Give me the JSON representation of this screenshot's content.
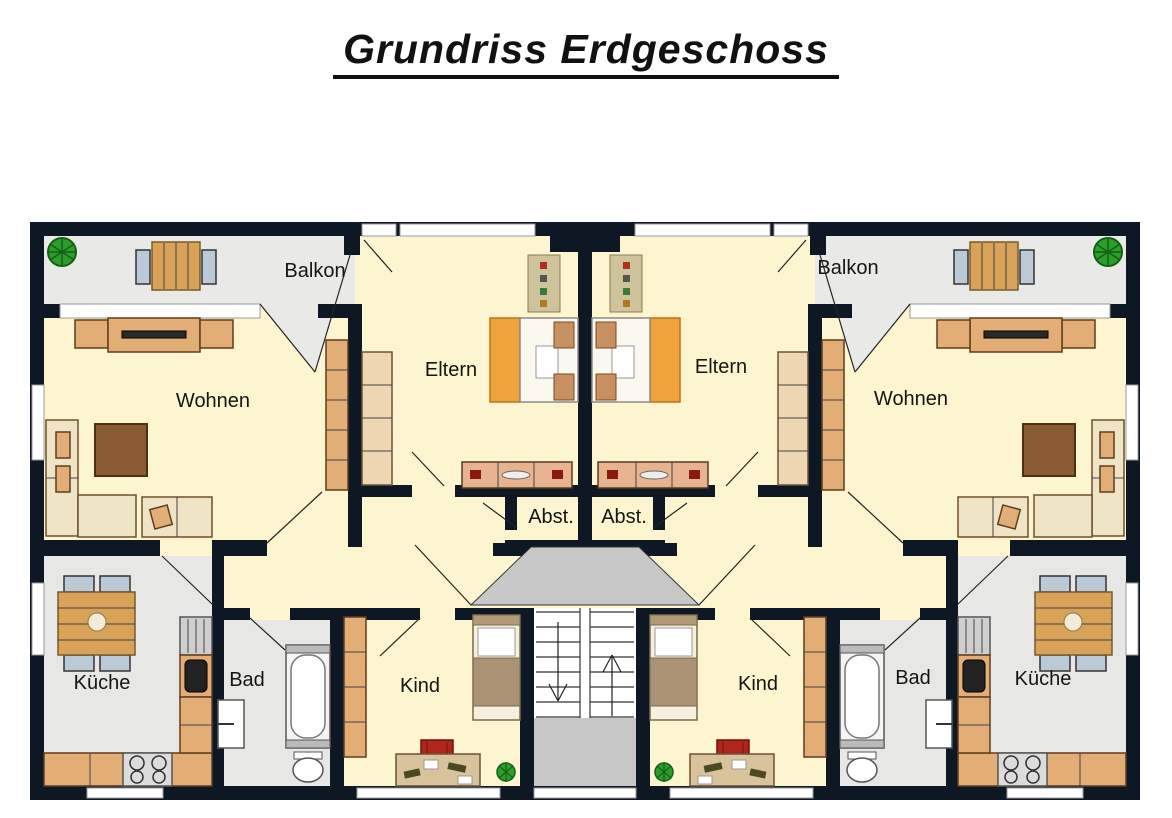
{
  "title": "Grundriss Erdgeschoss",
  "rooms": {
    "balkon": "Balkon",
    "wohnen": "Wohnen",
    "eltern": "Eltern",
    "abst": "Abst.",
    "kueche": "Küche",
    "bad": "Bad",
    "kind": "Kind"
  },
  "stairs": {
    "down_arrow": "down",
    "up_arrow": "up"
  },
  "palette": {
    "wall": "#0e1724",
    "room_yellow": "#fcf5cf",
    "balcony_grey": "#e9e9e7",
    "kitchen_bath_grey": "#e7e7e5",
    "stair_grey": "#c7c7c7",
    "furniture_tan": "#e3ad76",
    "furniture_light_tan": "#eed7b2",
    "sofa_cream": "#f0e4c6",
    "wood": "#d8a359",
    "bed_orange": "#f0a23c",
    "coffee_table_brown": "#8a5a33",
    "chair_blue_grey": "#bcc9d6",
    "desk_chair_red": "#b0261c",
    "plant_green": "#2aa02a"
  }
}
